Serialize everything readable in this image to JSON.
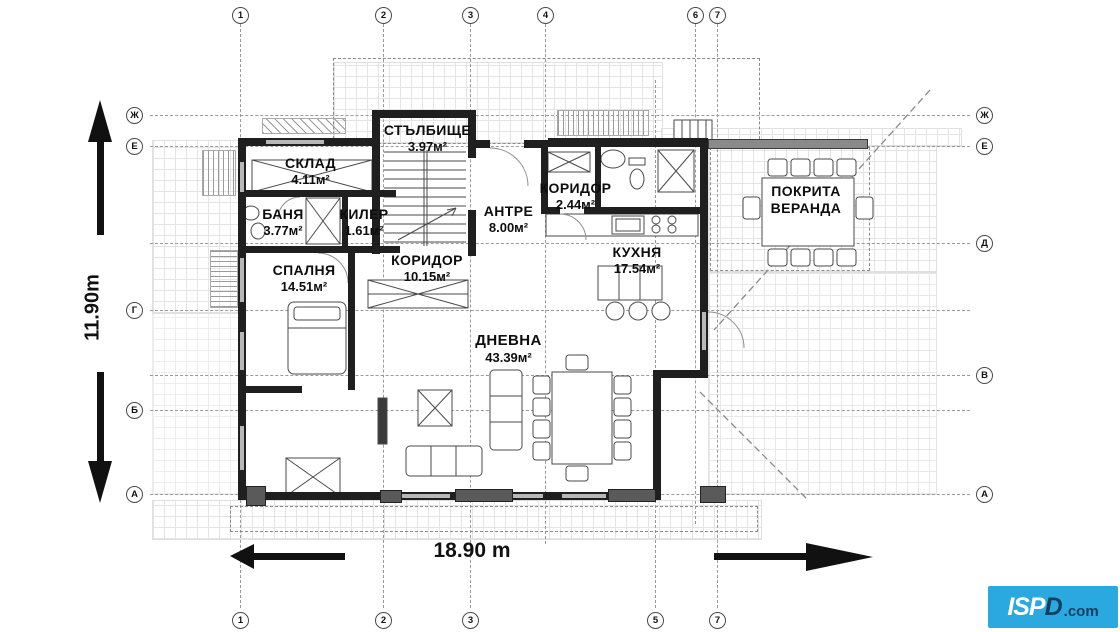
{
  "axes": {
    "top": [
      "1",
      "2",
      "3",
      "4",
      "6",
      "7"
    ],
    "bottom": [
      "1",
      "2",
      "3",
      "5",
      "7"
    ],
    "left": [
      "Ж",
      "Е",
      "Г",
      "Б",
      "А"
    ],
    "right": [
      "Ж",
      "Е",
      "Д",
      "В",
      "А"
    ]
  },
  "rooms": [
    {
      "name": "СТЪЛБИЩЕ",
      "area": "3.97м²"
    },
    {
      "name": "СКЛАД",
      "area": "4.11м²"
    },
    {
      "name": "БАНЯ",
      "area": "3.77м²"
    },
    {
      "name": "КИЛЕР",
      "area": "1.61м²"
    },
    {
      "name": "КОРИДОР",
      "area": "2.44м²"
    },
    {
      "name": "АНТРЕ",
      "area": "8.00м²"
    },
    {
      "name": "КУХНЯ",
      "area": "17.54м²"
    },
    {
      "name": "КОРИДОР",
      "area": "10.15м²"
    },
    {
      "name": "СПАЛНЯ",
      "area": "14.51м²"
    },
    {
      "name": "ДНЕВНА",
      "area": "43.39м²"
    },
    {
      "name": "ПОКРИТА ВЕРАНДА",
      "area": ""
    }
  ],
  "dimensions": {
    "vertical": "11.90m",
    "horizontal": "18.90 m"
  },
  "logo": {
    "brand_light": "ISP",
    "brand_dark": "D",
    "suffix": ".com"
  },
  "colors": {
    "wall": "#1f1f1f",
    "logo_bg": "#29a9e0",
    "logo_text_dark": "#123f60",
    "paving_line": "#e4e4e4"
  }
}
